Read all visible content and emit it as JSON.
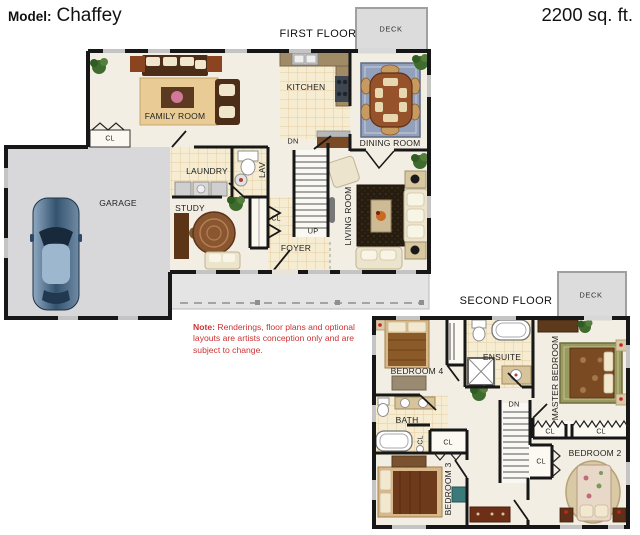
{
  "header": {
    "model_label": "Model:",
    "model_name": "Chaffey",
    "area": "2200 sq. ft."
  },
  "first_floor": {
    "title": "FIRST FLOOR",
    "deck": "DECK",
    "rooms": {
      "family_room": "FAMILY ROOM",
      "kitchen": "KITCHEN",
      "dining_room": "DINING ROOM",
      "laundry": "LAUNDRY",
      "lav": "LAV",
      "study": "STUDY",
      "garage": "GARAGE",
      "living_room": "LIVING ROOM",
      "foyer": "FOYER"
    },
    "markers": {
      "up": "UP",
      "dn": "DN",
      "closet": "CL"
    }
  },
  "note": {
    "label": "Note:",
    "text": "Renderings, floor plans and optional layouts are artists conception only and are subject to change."
  },
  "second_floor": {
    "title": "SECOND FLOOR",
    "deck": "DECK",
    "rooms": {
      "bedroom4": "BEDROOM 4",
      "ensuite": "ENSUITE",
      "master_bedroom": "MASTER BEDROOM",
      "bath": "BATH",
      "bedroom3": "BEDROOM 3",
      "bedroom2": "BEDROOM 2"
    },
    "markers": {
      "dn": "DN",
      "closet": "CL"
    }
  },
  "colors": {
    "wall": "#1a1a1a",
    "floor_cream": "#f3eee3",
    "tile": "#f6ecd2",
    "garage_gray": "#d8d8da",
    "deck_gray": "#dcdcdc",
    "note_red": "#cc3333"
  }
}
